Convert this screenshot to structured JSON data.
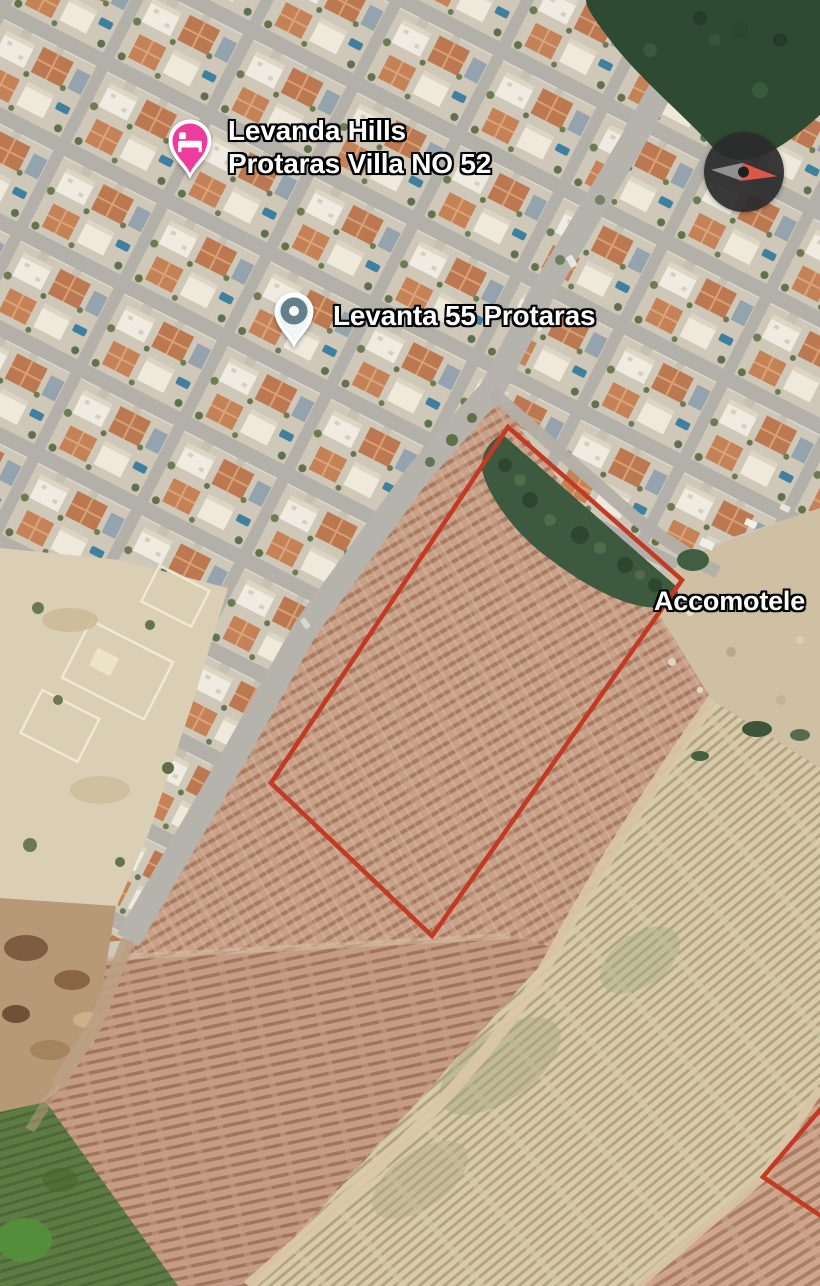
{
  "map": {
    "type": "satellite",
    "labels": {
      "lodging_marker": {
        "line1": "Levanda Hills",
        "line2": "Protaras Villa NO 52"
      },
      "place_marker": {
        "text": "Levanta 55 Protaras"
      },
      "area_label": {
        "text": "Accomotele"
      }
    },
    "icons": {
      "lodging_pin": "bed-icon",
      "place_pin": "dot-pin-icon",
      "compass": "compass-needle-icon"
    },
    "colors": {
      "lodging_pin": "#ee3c9e",
      "place_pin_inner": "#64808d",
      "plot_outline": "#c23a24",
      "compass_north": "#de5649",
      "compass_south": "#909090"
    },
    "plot_outlines_visible": 2
  }
}
